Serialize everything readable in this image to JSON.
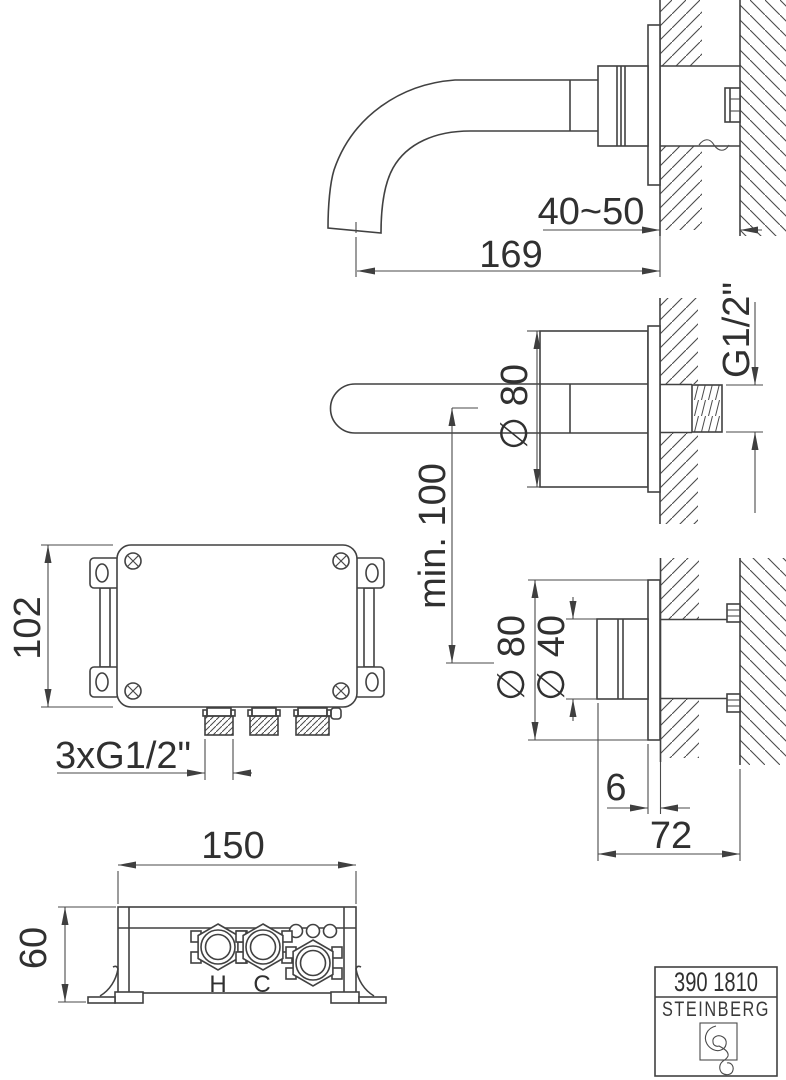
{
  "title_block": {
    "model": "390 1810",
    "brand": "STEINBERG"
  },
  "views": {
    "spout_side": {
      "dims": {
        "wall_range": "40~50",
        "length": "169"
      }
    },
    "spout_top": {
      "dims": {
        "rosette_dia": "∅ 80",
        "thread": "G1/2\"",
        "min_clearance": "min. 100"
      }
    },
    "handle_side": {
      "dims": {
        "rosette_dia": "∅ 80",
        "handle_dia": "∅ 40",
        "plate_thickness": "6",
        "depth": "72"
      }
    },
    "body_front": {
      "dims": {
        "height": "102",
        "connections": "3xG1/2\""
      }
    },
    "body_bottom": {
      "dims": {
        "width": "150",
        "depth": "60"
      },
      "ports": {
        "hot": "H",
        "cold": "C"
      }
    }
  },
  "colors": {
    "line": "#414141",
    "text": "#303030",
    "background": "#ffffff"
  }
}
